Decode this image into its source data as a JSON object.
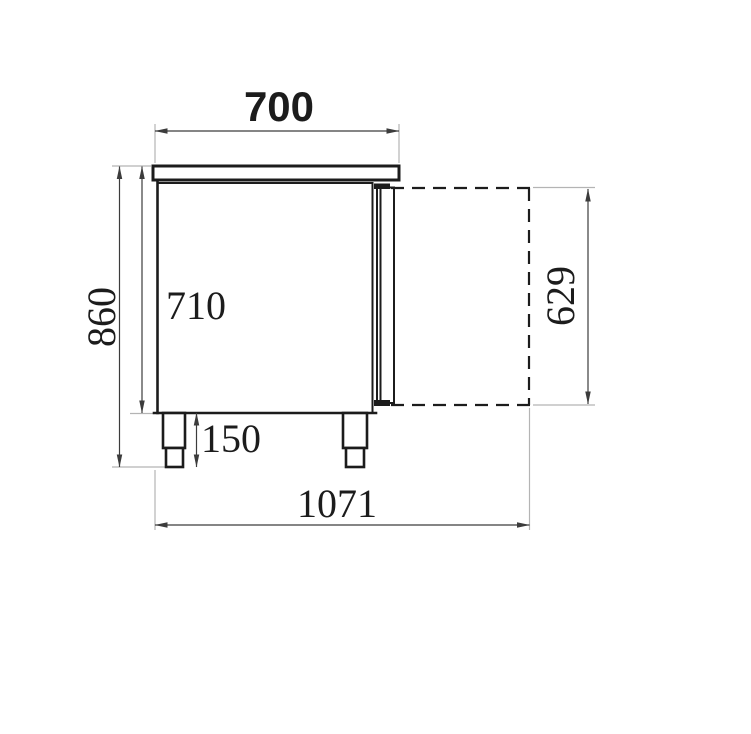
{
  "drawing": {
    "type": "technical-dimension-drawing",
    "subject": "refrigerated counter side profile with open door outline",
    "units_note": "",
    "labels": {
      "width_top": "700",
      "height_overall": "860",
      "height_body": "710",
      "height_legs": "150",
      "depth_total": "1071",
      "height_door": "629"
    }
  },
  "colors": {
    "line": "#1c1c1c",
    "dim": "#3c3c3c",
    "ext": "#b4b4b4",
    "background": "#ffffff"
  }
}
